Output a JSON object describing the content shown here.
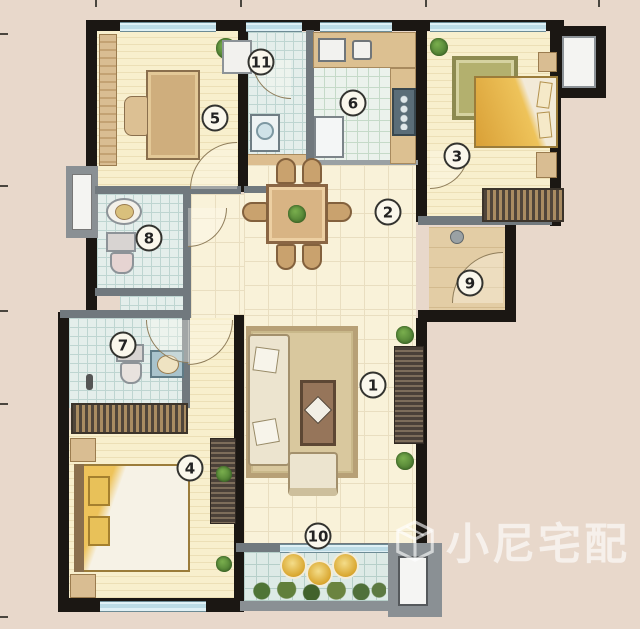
{
  "watermark": {
    "text": "小尼宅配",
    "logo": "cube-house-logo"
  },
  "rooms": [
    {
      "num": "1",
      "x": 373,
      "y": 385
    },
    {
      "num": "2",
      "x": 388,
      "y": 212
    },
    {
      "num": "3",
      "x": 457,
      "y": 156
    },
    {
      "num": "4",
      "x": 190,
      "y": 468
    },
    {
      "num": "5",
      "x": 215,
      "y": 118
    },
    {
      "num": "6",
      "x": 353,
      "y": 103
    },
    {
      "num": "7",
      "x": 123,
      "y": 345
    },
    {
      "num": "8",
      "x": 149,
      "y": 238
    },
    {
      "num": "9",
      "x": 470,
      "y": 283
    },
    {
      "num": "10",
      "x": 318,
      "y": 536
    },
    {
      "num": "11",
      "x": 261,
      "y": 62
    }
  ],
  "colors": {
    "background": "#e8d8cb",
    "outer_wall": "#1b1713",
    "partition": "#71797e",
    "window_glass": "#bcdbe5",
    "accent_gold": "#d9a62e",
    "wood_floor": "#f8efcd"
  }
}
